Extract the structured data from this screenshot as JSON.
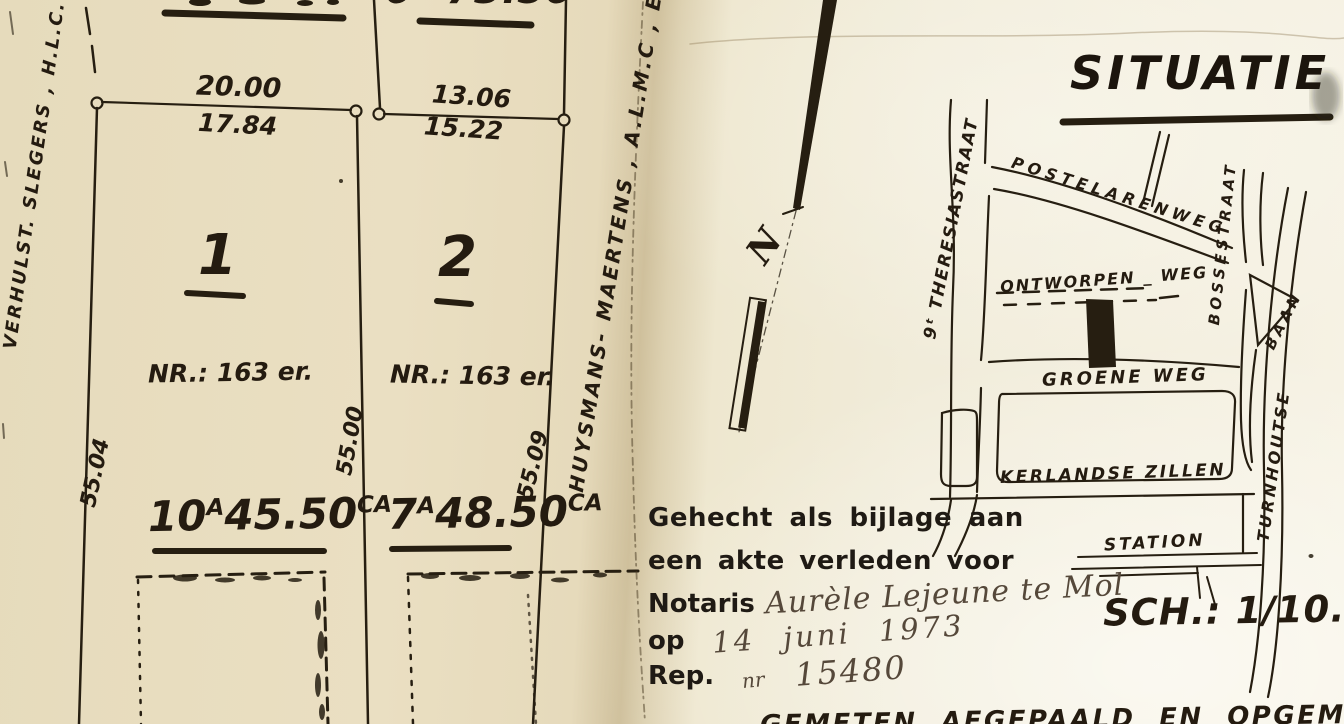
{
  "plan": {
    "strip_area_right": "0ᴬ 73.50",
    "dimensions": {
      "seg1_top": "20.00",
      "seg1_bottom": "17.84",
      "seg2_top": "13.06",
      "seg2_bottom": "15.22"
    },
    "depths": {
      "left": "55.04",
      "middle": "55.00",
      "right": "55.09"
    },
    "owners": {
      "left": "VERHULST. SLEGERS , H.L.C.",
      "right": "HUYSMANS- MAERTENS , A.L.M.C , EN"
    },
    "parcels": [
      {
        "number": "1",
        "cadastral_nr": "NR.: 163 er.",
        "area_main": "10",
        "area_unit1": "A",
        "area_frac": "45.50",
        "area_unit2": "CA"
      },
      {
        "number": "2",
        "cadastral_nr": "NR.: 163 er.",
        "area_main": "7",
        "area_unit1": "A",
        "area_frac": "48.50",
        "area_unit2": "CA"
      }
    ]
  },
  "north_arrow": {
    "letter": "N"
  },
  "situatie": {
    "title": "SITUATIE",
    "streets": {
      "theresiastraat": "9ᵗ THERESIASTRAAT",
      "postelarenweg": "POSTELARENWEG",
      "ontworpen_weg": "ONTWORPEN _ WEG",
      "groene_weg": "GROENE WEG",
      "kerlandse_zillen": "KERLANDSE ZILLEN",
      "bossestraat": "BOSSESTRAAT",
      "turnhoutse": "TURNHOUTSE",
      "baan": "BAAN",
      "station": "STATION"
    },
    "scale": "SCH.: 1/10.00"
  },
  "notary": {
    "line1": "Gehecht als bijlage aan",
    "line2": "een akte verleden voor",
    "notaris_label": "Notaris",
    "notaris_value": "Aurèle Lejeune te Mol",
    "op_label": "op",
    "op_value": "14 juni 1973",
    "rep_label": "Rep.",
    "rep_nr": "nr",
    "rep_value": "15480"
  },
  "footer": "GEMETEN AFGEPAALD EN OPGEMAAKT D",
  "colors": {
    "ink": "#241b10",
    "hand_ink": "#55483a"
  }
}
